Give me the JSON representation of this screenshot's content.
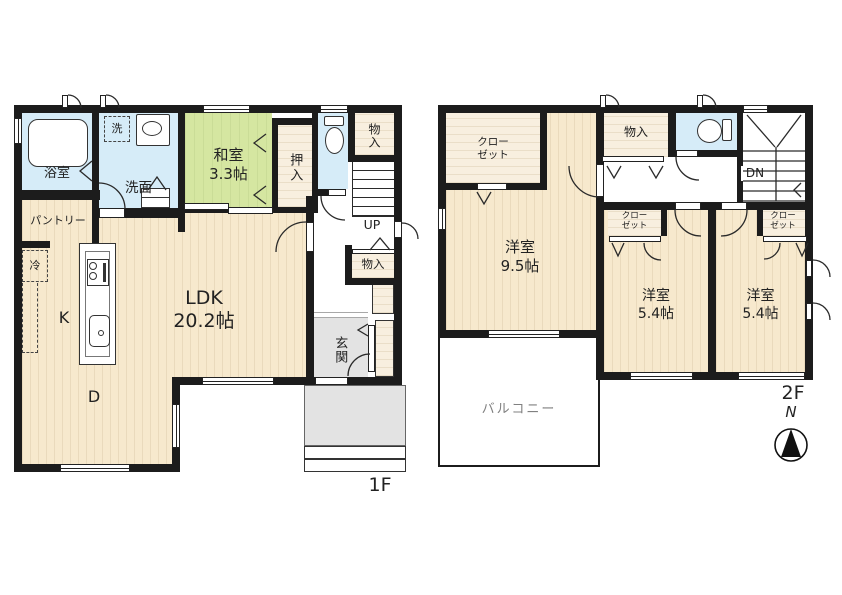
{
  "f1": {
    "label": "1F",
    "bathroom": "浴室",
    "washer": "洗",
    "washroom": "洗面",
    "japanese_room": "和室\n3.3帖",
    "oshiire": "押入",
    "storage_top": "物入",
    "up": "UP",
    "storage_hall": "物入",
    "pantry": "パントリー",
    "fridge": "冷",
    "ldk": "LDK\n20.2帖",
    "kitchen": "K",
    "dining": "D",
    "entrance": "玄関"
  },
  "f2": {
    "label": "2F",
    "closet_nw": "クロー\nゼット",
    "room_95": "洋室\n9.5帖",
    "storage": "物入",
    "down": "DN",
    "closet_a": "クロー\nゼット",
    "closet_b": "クロー\nゼット",
    "room_54_a": "洋室\n5.4帖",
    "room_54_b": "洋室\n5.4帖",
    "balcony": "バルコニー"
  },
  "compass": {
    "north": "N"
  },
  "colors": {
    "wall": "#1c1c1c",
    "wood_floor": "#f7e9cd",
    "tatami_green": "#d5e6a1",
    "water_blue": "#d6ecf8",
    "closet_beige": "#f8efdf",
    "entrance_gray": "#e3e3e3",
    "balcony_text": "#808080"
  }
}
